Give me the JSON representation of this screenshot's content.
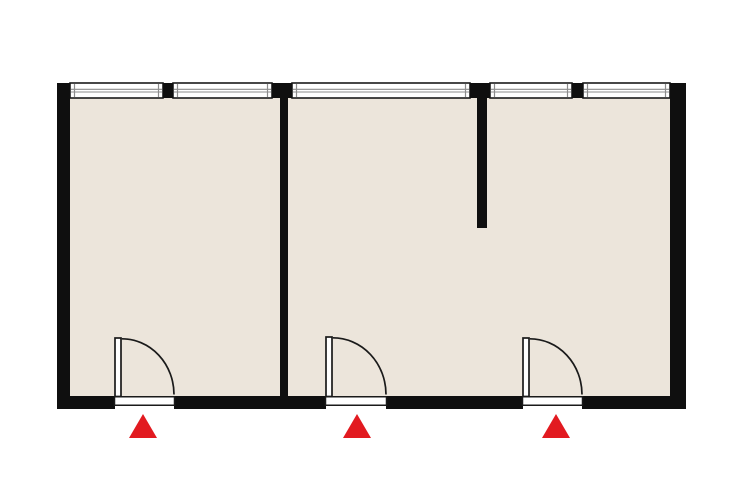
{
  "canvas": {
    "width": 740,
    "height": 493
  },
  "palette": {
    "background": "#ffffff",
    "wall": "#0f0f0f",
    "floor": "#ece5db",
    "window_fill": "#ffffff",
    "window_outline": "#1a1a1a",
    "window_glass": "#8c8c8c",
    "door_outline": "#1a1a1a",
    "door_fill": "#ffffff",
    "entrance_marker": "#e21a20"
  },
  "floor": {
    "x": 62,
    "y": 88,
    "width": 616,
    "height": 314
  },
  "walls": [
    {
      "name": "outer-wall-left",
      "x": 57,
      "y": 83,
      "width": 13,
      "height": 326
    },
    {
      "name": "outer-wall-right",
      "x": 670,
      "y": 83,
      "width": 16,
      "height": 326
    },
    {
      "name": "top-wall-pier-1",
      "x": 163,
      "y": 83,
      "width": 10,
      "height": 15
    },
    {
      "name": "top-wall-pier-2",
      "x": 272,
      "y": 83,
      "width": 20,
      "height": 15
    },
    {
      "name": "top-wall-pier-3",
      "x": 470,
      "y": 83,
      "width": 20,
      "height": 15
    },
    {
      "name": "top-wall-pier-4",
      "x": 572,
      "y": 83,
      "width": 11,
      "height": 15
    },
    {
      "name": "bottom-wall-segment-1",
      "x": 57,
      "y": 396,
      "width": 58,
      "height": 13
    },
    {
      "name": "bottom-wall-segment-2",
      "x": 174,
      "y": 396,
      "width": 152,
      "height": 13
    },
    {
      "name": "bottom-wall-segment-3",
      "x": 386,
      "y": 396,
      "width": 137,
      "height": 13
    },
    {
      "name": "bottom-wall-segment-4",
      "x": 582,
      "y": 396,
      "width": 104,
      "height": 13
    },
    {
      "name": "interior-wall",
      "x": 280,
      "y": 95,
      "width": 8,
      "height": 302
    },
    {
      "name": "partial-wall",
      "x": 477,
      "y": 95,
      "width": 10,
      "height": 133
    }
  ],
  "windows": [
    {
      "x": 70,
      "y": 83,
      "width": 93,
      "height": 15
    },
    {
      "x": 173,
      "y": 83,
      "width": 99,
      "height": 15
    },
    {
      "x": 292,
      "y": 83,
      "width": 178,
      "height": 15
    },
    {
      "x": 490,
      "y": 83,
      "width": 82,
      "height": 15
    },
    {
      "x": 583,
      "y": 83,
      "width": 87,
      "height": 15
    }
  ],
  "doors": [
    {
      "hinge_x": 115,
      "leaf_top_y": 338,
      "wall_y": 396,
      "radius": 59,
      "leaf_width": 6
    },
    {
      "hinge_x": 326,
      "leaf_top_y": 337,
      "wall_y": 396,
      "radius": 60,
      "leaf_width": 6
    },
    {
      "hinge_x": 523,
      "leaf_top_y": 338,
      "wall_y": 396,
      "radius": 59,
      "leaf_width": 6
    }
  ],
  "entrance_markers": [
    {
      "cx": 143,
      "apex_y": 414,
      "base_y": 438,
      "half_width": 14
    },
    {
      "cx": 357,
      "apex_y": 414,
      "base_y": 438,
      "half_width": 14
    },
    {
      "cx": 556,
      "apex_y": 414,
      "base_y": 438,
      "half_width": 14
    }
  ]
}
